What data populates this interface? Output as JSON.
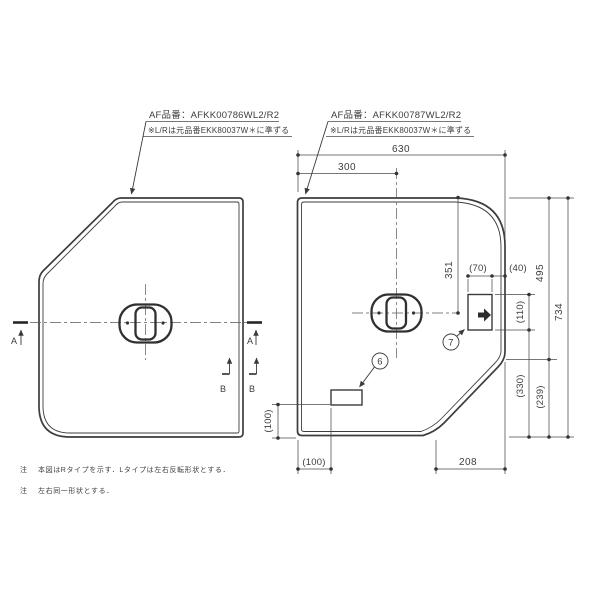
{
  "page": {
    "background": "#ffffff",
    "line_color": "#3d3d3d"
  },
  "left_panel": {
    "label_line1": "AF品番：AFKK00786WL2/R2",
    "label_line2": "※L/Rは元品番EKK80037W＊に準ずる",
    "section_markers": {
      "a_left": "A",
      "a_right": "A",
      "b_inner": "B",
      "b_outer": "B"
    }
  },
  "right_panel": {
    "label_line1": "AF品番：AFKK00787WL2/R2",
    "label_line2": "※L/Rは元品番EKK80037W＊に準ずる",
    "callouts": {
      "c6": "6",
      "c7": "7"
    },
    "dimensions": {
      "total_width": "630",
      "handle_x": "300",
      "handle_y": "351",
      "grip_width": "(70)",
      "grip_edge": "(40)",
      "right_upper": "495",
      "total_height": "734",
      "grip_height": "(110)",
      "lower_330": "(330)",
      "lower_239": "(239)",
      "bottom_208": "208",
      "bottom_100": "(100)",
      "left_100": "(100)"
    }
  },
  "notes": [
    {
      "prefix": "注",
      "text": "本図はRタイプを示す．Lタイプは左右反転形状とする．"
    },
    {
      "prefix": "注",
      "text": "左右同一形状とする．"
    }
  ]
}
